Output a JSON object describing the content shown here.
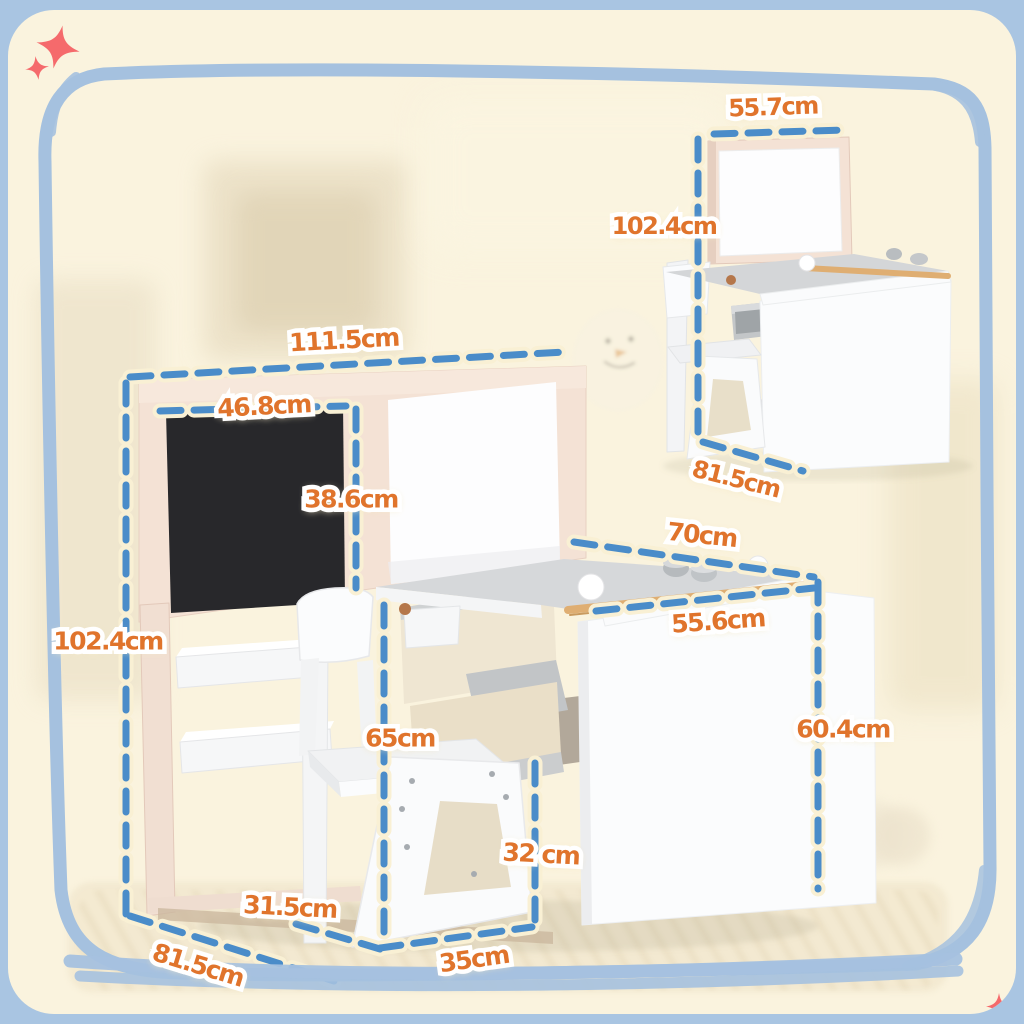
{
  "palette": {
    "outer_blue": "#a9c5e2",
    "border_blue": "#a5c1df",
    "card_cream": "#faf3de",
    "dash_blue": "#4a8cc9",
    "dash_halo_cream": "#f9f0d4",
    "label_orange": "#e0742c",
    "label_outline_white": "#ffffff",
    "sparkle_coral": "#f56a6c",
    "frame_pink": "#f4e2d5",
    "chalkboard_black": "#28282b",
    "whiteboard_white": "#fdfdfe",
    "desk_top_gray": "#d6d8da",
    "wood_tan": "#dfae72",
    "furniture_white": "#fafbfc"
  },
  "labels": {
    "main_width": {
      "text": "111.5cm"
    },
    "board_width": {
      "text": "46.8cm"
    },
    "board_height": {
      "text": "38.6cm"
    },
    "main_height": {
      "text": "102.4cm"
    },
    "desk_depth": {
      "text": "70cm"
    },
    "desk_front_width": {
      "text": "55.6cm"
    },
    "desk_height": {
      "text": "60.4cm"
    },
    "chair_height": {
      "text": "65cm"
    },
    "seat_height": {
      "text": "32 cm"
    },
    "chair_depth": {
      "text": "31.5cm"
    },
    "floor_depth": {
      "text": "81.5cm"
    },
    "seat_width": {
      "text": "35cm"
    },
    "inset_width": {
      "text": "55.7cm"
    },
    "inset_height": {
      "text": "102.4cm"
    },
    "inset_depth": {
      "text": "81.5cm"
    }
  },
  "icons": {
    "sparkle_top_left_large": "four-point-sparkle",
    "sparkle_top_left_small": "four-point-sparkle",
    "sparkle_bottom_right": "four-point-sparkle"
  }
}
